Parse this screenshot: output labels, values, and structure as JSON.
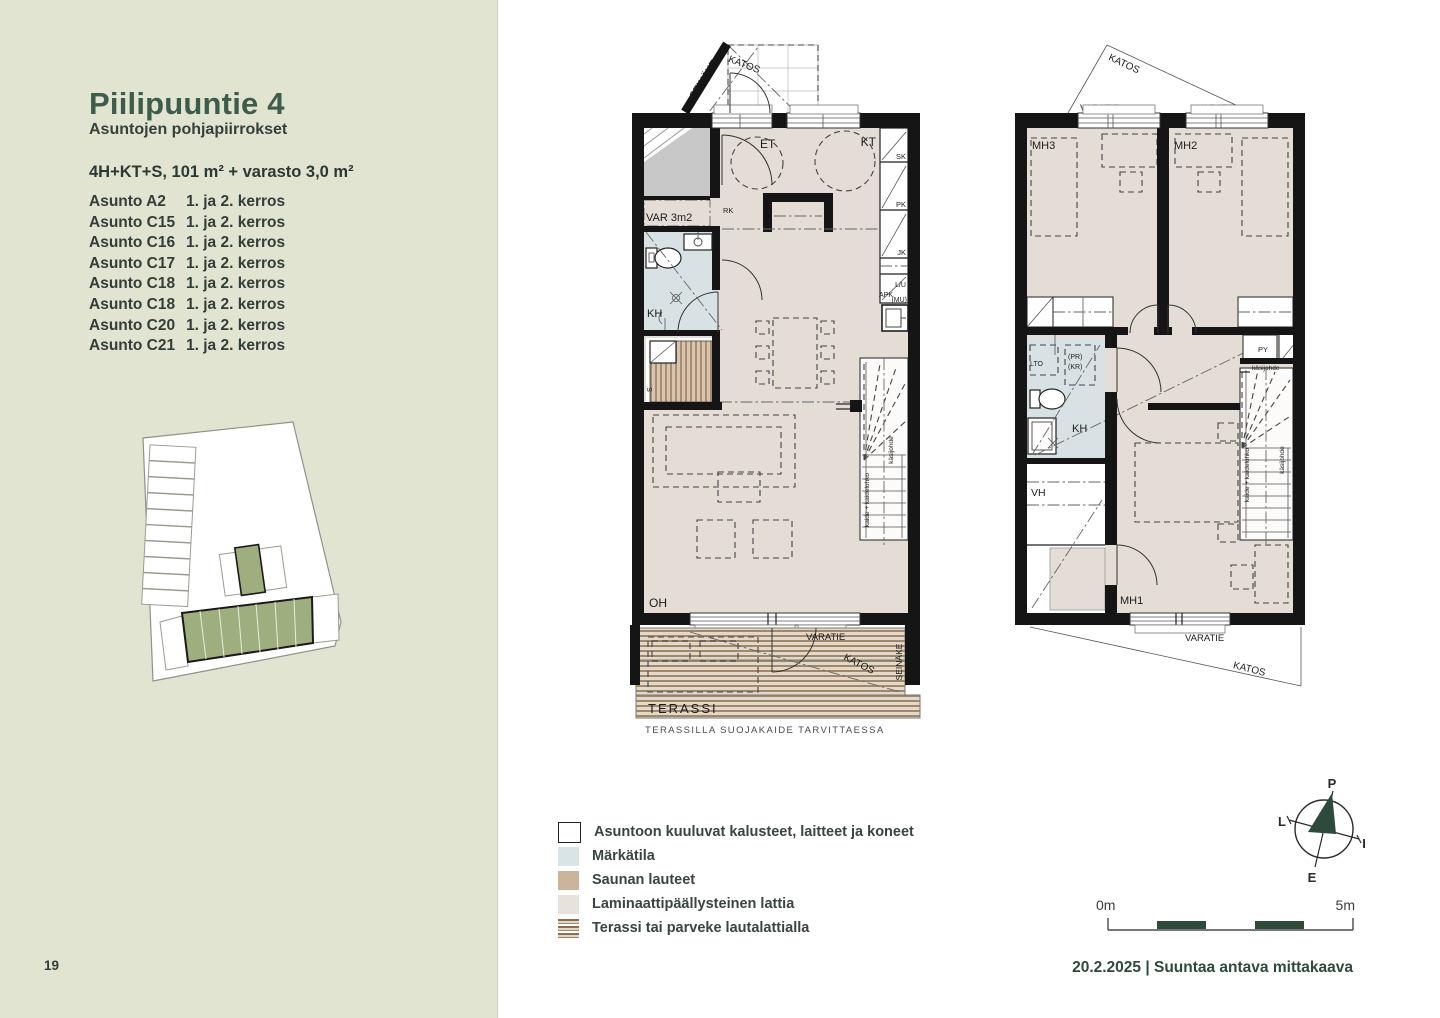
{
  "page": {
    "number": "19",
    "footer": "20.2.2025 | Suuntaa antava mittakaava"
  },
  "sidebar": {
    "title": "Piilipuuntie 4",
    "subtitle": "Asuntojen pohjapiirrokset",
    "spec": "4H+KT+S, 101 m² + varasto 3,0 m²",
    "apartments": [
      {
        "name": "Asunto A2",
        "floors": "1. ja 2. kerros"
      },
      {
        "name": "Asunto C15",
        "floors": "1. ja 2. kerros"
      },
      {
        "name": "Asunto C16",
        "floors": "1. ja 2. kerros"
      },
      {
        "name": "Asunto C17",
        "floors": "1. ja 2. kerros"
      },
      {
        "name": "Asunto C18",
        "floors": "1. ja 2. kerros"
      },
      {
        "name": "Asunto C18",
        "floors": "1. ja 2. kerros"
      },
      {
        "name": "Asunto C20",
        "floors": "1. ja 2. kerros"
      },
      {
        "name": "Asunto C21",
        "floors": "1. ja 2. kerros"
      }
    ]
  },
  "floor1": {
    "seinake_top": "SEINÄKE",
    "katos_top": "KATOS",
    "et": "ET",
    "kt": "KT",
    "rk": "RK",
    "sk": "SK",
    "pk": "PK",
    "jk": "JK",
    "lu": "L/U",
    "apk": "APK",
    "mu": "(MU)",
    "var": "VAR 3m2",
    "kh": "KH",
    "s": "S",
    "oh": "OH",
    "kaide": "kaide + kaidelohko",
    "kasijohde": "käsijohde",
    "varatie": "VARATIE",
    "katos_bottom": "KATOS",
    "seinake_bottom": "SEINÄKE",
    "terassi": "TERASSI",
    "caption": "TERASSILLA SUOJAKAIDE TARVITTAESSA"
  },
  "floor2": {
    "katos_top": "KATOS",
    "varatie_left": "VARATIE",
    "varatie_right": "VARATIE",
    "mh3": "MH3",
    "mh2": "MH2",
    "mh1": "MH1",
    "lto": "LTO",
    "pr": "(PR)",
    "kr": "(KR)",
    "py": "PY",
    "kh": "KH",
    "vh": "VH",
    "kasijohde_top": "käsijohde",
    "kaide": "kaide + kaidelohko",
    "kasijohde_side": "käsijohde",
    "varatie_bottom": "VARATIE",
    "katos_bottom": "KATOS"
  },
  "legend": {
    "items": [
      {
        "label": "Asuntoon kuuluvat kalusteet, laitteet ja koneet"
      },
      {
        "label": "Märkätila"
      },
      {
        "label": "Saunan lauteet"
      },
      {
        "label": "Laminaattipäällysteinen lattia"
      },
      {
        "label": "Terassi tai parveke lautalattialla"
      }
    ]
  },
  "compass": {
    "north": "P",
    "west": "L",
    "east": "I",
    "south": "E"
  },
  "scalebar": {
    "start": "0m",
    "end": "5m"
  },
  "colors": {
    "sidebar_bg": "#e2e4d2",
    "accent_green": "#2e4a3c",
    "title_green": "#3d5c4b",
    "floor": "#e3ddd5",
    "wet_room": "#d8e2e4",
    "sauna_bench": "#d8c5b0",
    "deck_stripe": "#a2886a",
    "storage_gray": "#c8c8c8",
    "site_green": "#9fae7e",
    "wall": "#151515"
  }
}
